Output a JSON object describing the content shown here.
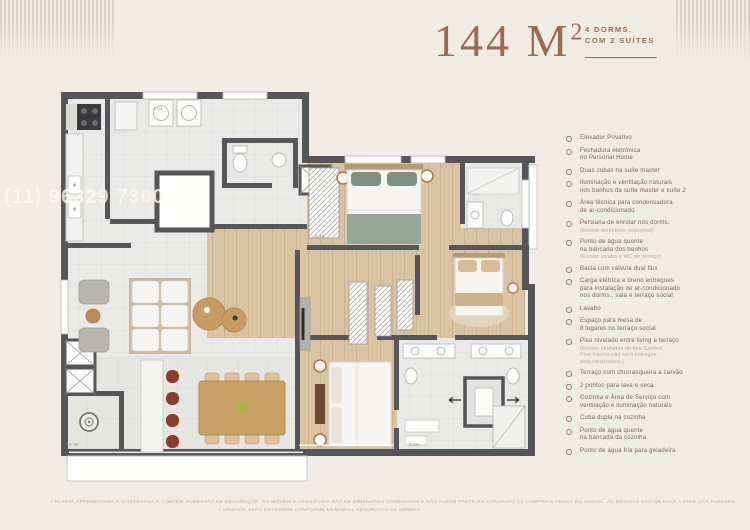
{
  "header": {
    "area_main": "144 M",
    "area_sup": "2",
    "subtitle_line1": "4 DORMS.",
    "subtitle_line2": "COM 2 SUÍTES",
    "accent_color": "#9b6a52"
  },
  "watermark": {
    "text": "(11) 96329 7300"
  },
  "features": {
    "items": [
      {
        "label": "Elevador Privativo"
      },
      {
        "label": "Fechadura eletrônica\nno Personal Home"
      },
      {
        "label": "Duas cubas na suíte master"
      },
      {
        "label": "Iluminação e ventilação naturais\nnos banhos da suíte master e suíte 2"
      },
      {
        "label": "Área técnica para condensadora\nde ar-condicionado"
      },
      {
        "label": "Persiana de enrolar nos dorms.",
        "note": "(Exceto dormitório reversível)"
      },
      {
        "label": "Ponto de água quente\nna bancada dos banhos",
        "note": "(Exceto lavabo e WC de serviço)"
      },
      {
        "label": "Bacia com válvula dual flux"
      },
      {
        "label": "Carga elétrica e dreno entregues\npara instalação de ar-condicionado\nnos dorms., sala e terraço social"
      },
      {
        "label": "Lavabo"
      },
      {
        "label": "Espaço para mesa de\n8 lugares no terraço social"
      },
      {
        "label": "Piso nivelado entre living e terraço",
        "note": "(Exceto unidades do tipo Garden.\nPiso interno não será entregue\npela construtora.)"
      },
      {
        "label": "Terraço com churrasqueira a carvão"
      },
      {
        "label": "2 pontos para lava e seca"
      },
      {
        "label": "Cozinha e Área de Serviço com\nventilação e iluminação naturais"
      },
      {
        "label": "Cuba dupla na cozinha"
      },
      {
        "label": "Ponto de água quente\nna bancada da cozinha"
      },
      {
        "label": "Ponto de água fria para geladeira"
      }
    ]
  },
  "plan": {
    "dimensions": [
      {
        "text": "4.04",
        "x": 96,
        "y": 18
      },
      {
        "text": "3.16",
        "x": 258,
        "y": 146
      },
      {
        "text": "5.10",
        "x": 398,
        "y": 164
      },
      {
        "text": "3.40",
        "x": 352,
        "y": 354
      },
      {
        "text": "0.36",
        "x": 12,
        "y": 354
      }
    ]
  },
  "disclaimer": {
    "line1": "A PLANTA APRESENTADA É ILUSTRATIVA E CONTÉM SUGESTÃO DE DECORAÇÃO. OS MÓVEIS E UTENSÍLIOS SÃO DE DIMENSÕES COMERCIAIS E NÃO FAZEM PARTE DO CONTRATO DE COMPRA E VENDA DO IMÓVEL. AS MEDIDAS SÃO DE FACE A FACE DAS PAREDES.",
    "line2": "A UNIDADE SERÁ ENTREGUE CONFORME MEMORIAL DESCRITIVO DE VENDAS."
  }
}
